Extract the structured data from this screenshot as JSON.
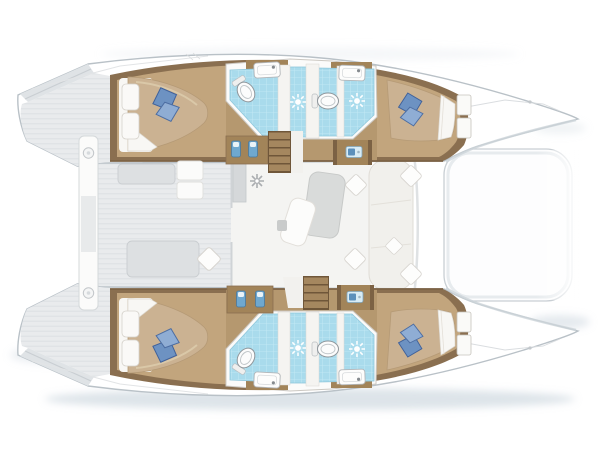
{
  "meta": {
    "description": "Catamaran sailing yacht floor plan, top-down view, bows pointing right",
    "visible_text": "none"
  },
  "vessel": {
    "type": "catamaran",
    "layout": "4 double cabins, 4 bathrooms, central saloon",
    "orientation": "bows-right"
  },
  "areas": {
    "port_hull_top": {
      "aft_cabin": {
        "bed": "double island bed",
        "blue_pillows": 2,
        "white_pillows": 2
      },
      "bathrooms": {
        "count": 2,
        "toilets": 1,
        "showers": 1,
        "sinks": 2
      },
      "forward_cabin": {
        "bed": "double tapered bed",
        "blue_pillows": 2,
        "shelves": 2
      }
    },
    "starboard_hull_bottom": {
      "aft_cabin": {
        "bed": "double island bed",
        "blue_pillows": 2,
        "white_pillows": 2
      },
      "bathrooms": {
        "count": 2,
        "toilets": 1,
        "showers": 1,
        "sinks": 2
      },
      "forward_cabin": {
        "bed": "double tapered bed",
        "blue_pillows": 2,
        "shelves": 2
      }
    },
    "saloon": {
      "table": 1,
      "chaise": 1,
      "settee": "forward L-settee",
      "cushions": 5,
      "galley_counters": 2,
      "nav_desks": 2,
      "companionway_stairs": 2
    },
    "cockpit": {
      "benches": 2,
      "seats": 2
    },
    "trampoline": {
      "present": true
    },
    "stern": {
      "crossbar": true,
      "cleats": 2,
      "transom_steps": 2
    }
  },
  "icons": [
    {
      "name": "shower-rose-icon",
      "count": 4
    },
    {
      "name": "toilet-icon",
      "count": 4
    },
    {
      "name": "sink-basin-icon",
      "count": 4
    },
    {
      "name": "sink-tap-icon",
      "count": 4
    },
    {
      "name": "galley-unit-icon",
      "count": 2
    },
    {
      "name": "vent-fan-icon",
      "count": 1
    },
    {
      "name": "cushion-icon",
      "count": 5
    },
    {
      "name": "cleat-icon",
      "count": 2
    },
    {
      "name": "blue-pillow-icon",
      "count": 8
    }
  ],
  "colors": {
    "hull_outline": "#b9c1c7",
    "deck_gray": "#e9ebed",
    "deck_stripe": "#e0e3e6",
    "wall_wood": "#8a6f50",
    "mid_wood": "#a28459",
    "floor_wood": "#c2a57d",
    "corridor_wood": "#b5986f",
    "bed_tan": "#cbb292",
    "sheet_white": "#f8f7f4",
    "pillow_blue": "#6d92c2",
    "pillow_blue_dark": "#40619a",
    "tile_blue": "#a9dbec",
    "tile_grid": "#c8ecf6",
    "table_gray": "#d9dbda",
    "saloon_floor": "#f4f4f2",
    "accent_blue": "#5b90bb",
    "shadow_blue": "#bcc9d4"
  }
}
